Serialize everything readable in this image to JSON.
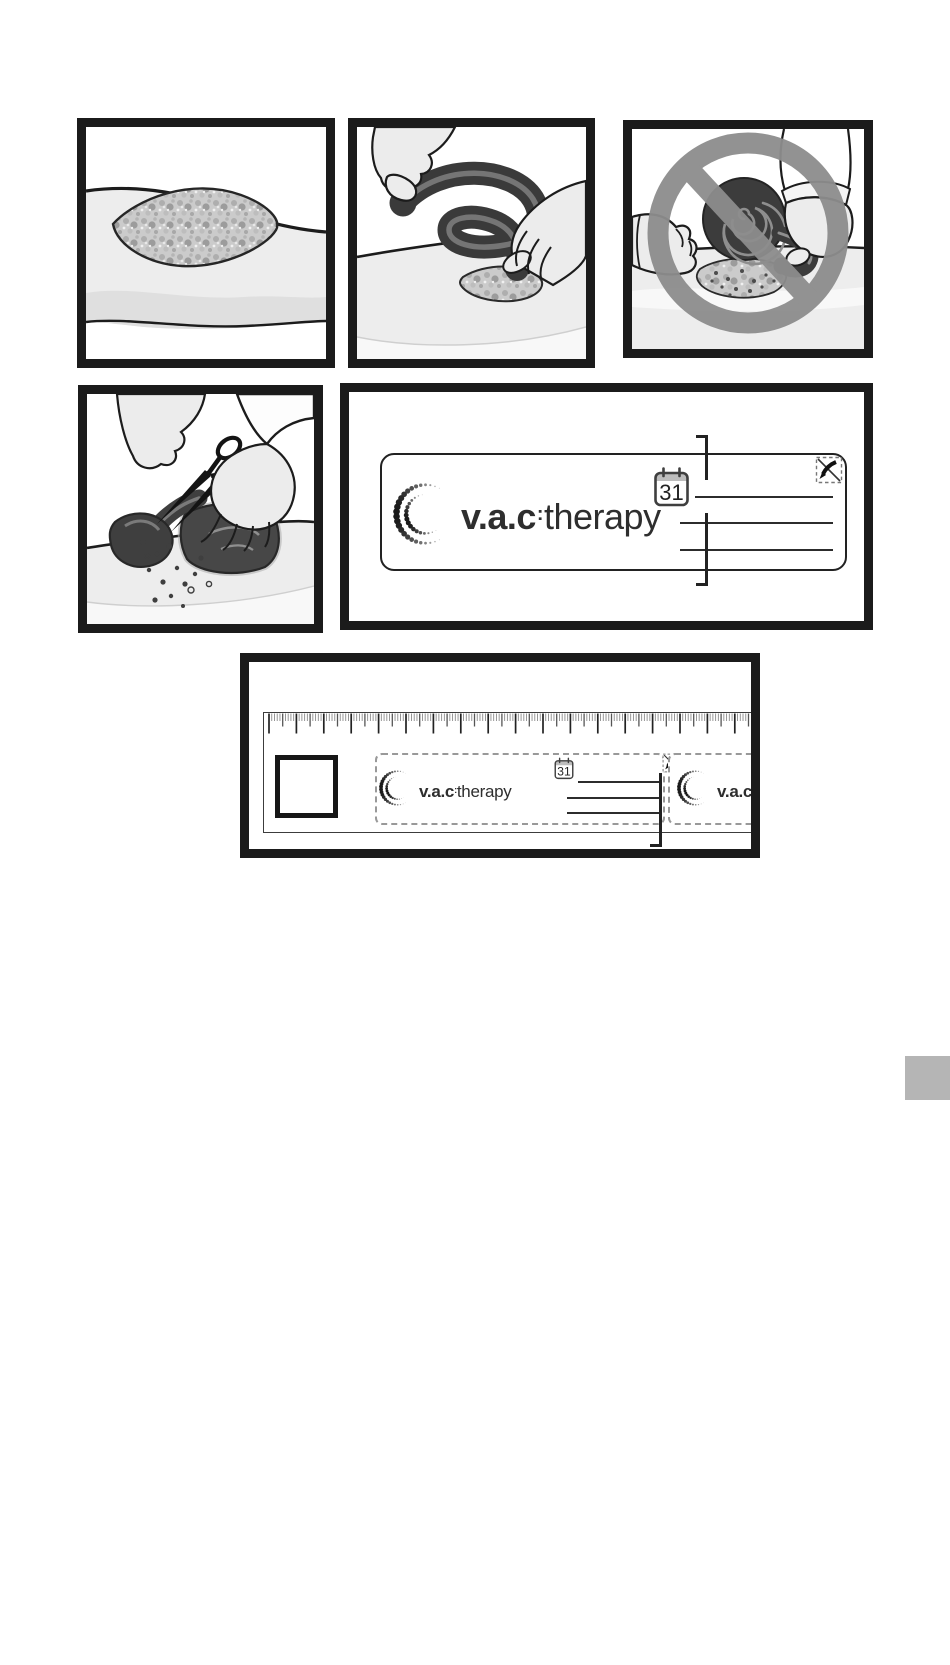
{
  "page": {
    "background": "#ffffff",
    "edge_tab_color": "#b5b5b5"
  },
  "branding": {
    "logo_bold": "v.a.c",
    "logo_sep": ":",
    "logo_rest": "therapy"
  },
  "label_card": {
    "calendar_day": "31",
    "write_line_count": 3
  },
  "ruler_card": {
    "calendar_day": "31",
    "write_line_count": 3
  },
  "palette": {
    "frame": "#1b1b1b",
    "foam": "#3a3a3a",
    "drape": "#474747",
    "skin": "#ececec",
    "limb": "#ededed",
    "prohibition_sign": "#8d8d8d",
    "wound_fill": "#cbcbcb",
    "ink": "#2c2c2c",
    "dashed_border": "#999999"
  }
}
